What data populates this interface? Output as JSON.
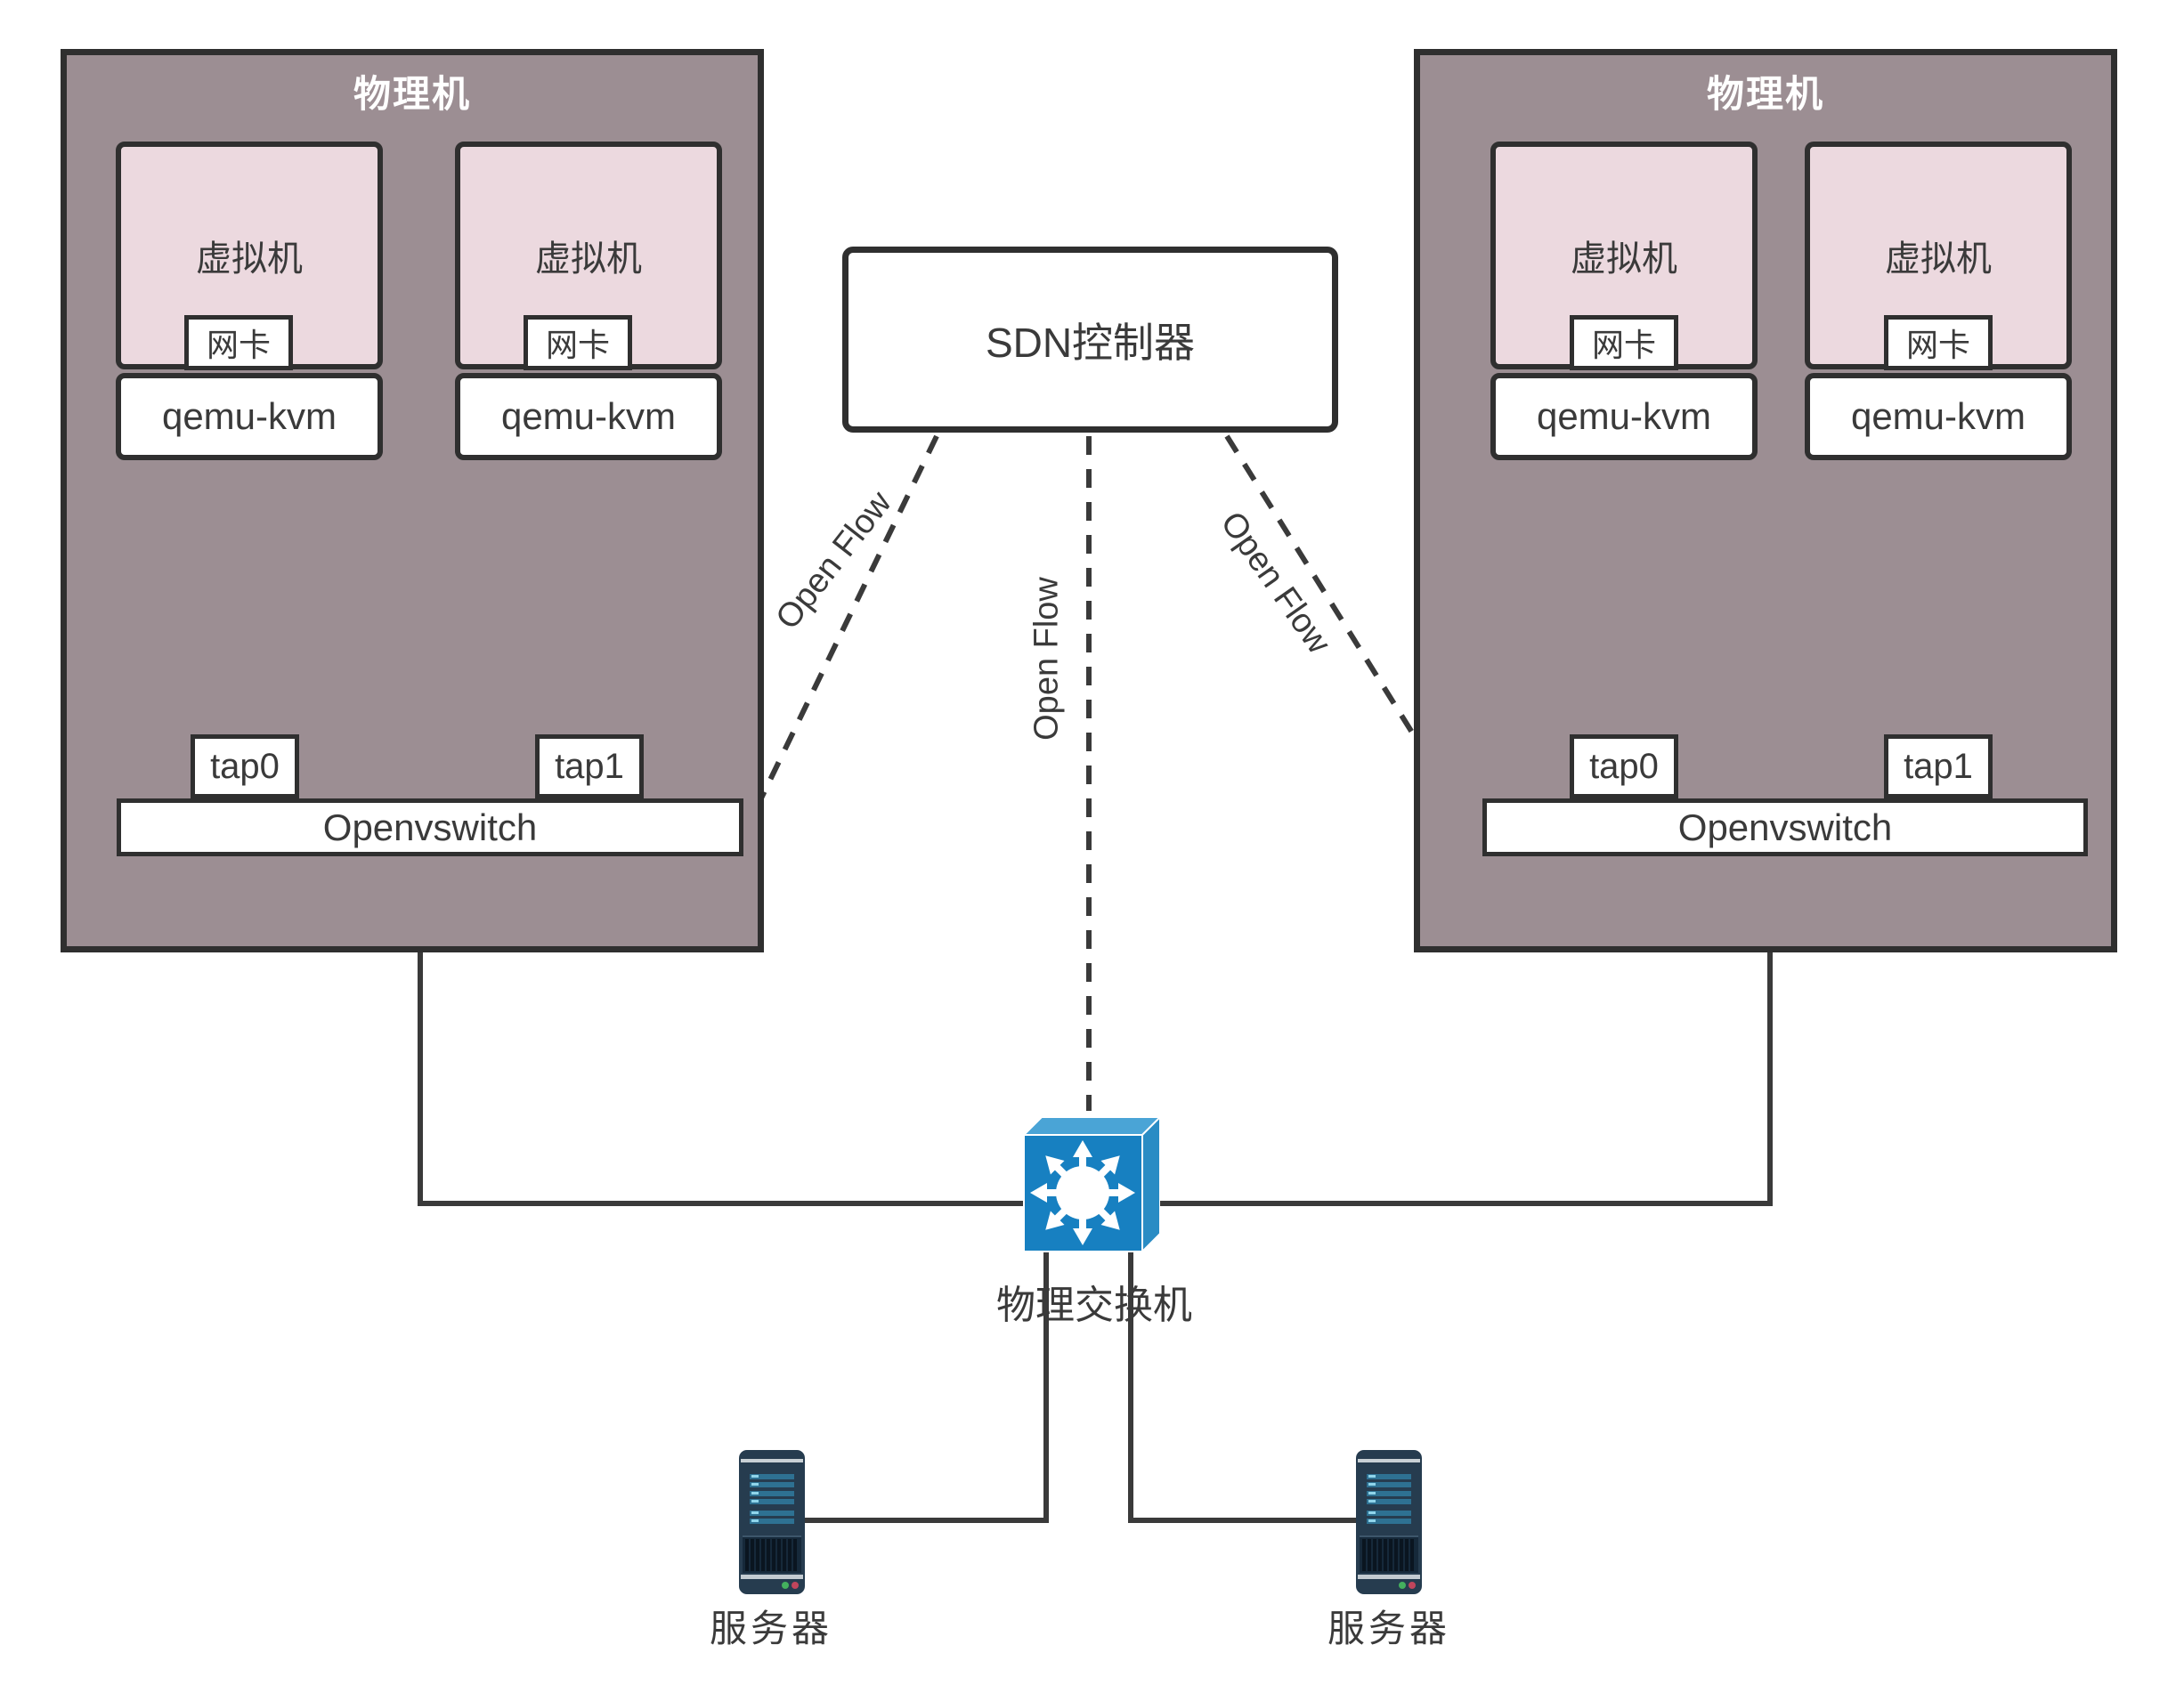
{
  "hosts": [
    {
      "label": "物理机",
      "vswitch_label": "Openvswitch",
      "vms": [
        {
          "label": "虚拟机",
          "nic_label": "网卡",
          "hypervisor_label": "qemu-kvm",
          "tap_label": "tap0"
        },
        {
          "label": "虚拟机",
          "nic_label": "网卡",
          "hypervisor_label": "qemu-kvm",
          "tap_label": "tap1"
        }
      ]
    },
    {
      "label": "物理机",
      "vswitch_label": "Openvswitch",
      "vms": [
        {
          "label": "虚拟机",
          "nic_label": "网卡",
          "hypervisor_label": "qemu-kvm",
          "tap_label": "tap0"
        },
        {
          "label": "虚拟机",
          "nic_label": "网卡",
          "hypervisor_label": "qemu-kvm",
          "tap_label": "tap1"
        }
      ]
    }
  ],
  "controller": {
    "label": "SDN控制器"
  },
  "links": {
    "protocol_label": "Open Flow"
  },
  "physical_switch": {
    "label": "物理交换机",
    "icon": "crossconnect-switch-icon"
  },
  "servers": [
    {
      "label": "服务器",
      "icon": "server-tower-icon"
    },
    {
      "label": "服务器",
      "icon": "server-tower-icon"
    }
  ],
  "colors": {
    "host_fill": "#9c8e93",
    "vm_fill": "#ecd9df",
    "box_border": "#2f2f2f",
    "line": "#3a3a3a",
    "switch_front": "#1780c1",
    "switch_bevel": "#4aa4d6",
    "server_body": "#263c4f",
    "server_stripe": "#2e7192"
  }
}
